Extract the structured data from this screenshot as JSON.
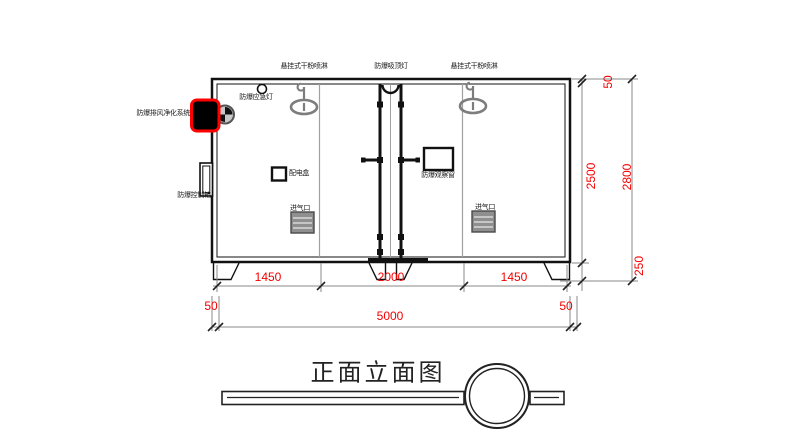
{
  "drawing": {
    "title": "正面立面图",
    "labels": {
      "sprinkler_left": "悬挂式干粉喷淋",
      "ceiling_light": "防爆吸顶灯",
      "sprinkler_right": "悬挂式干粉喷淋",
      "emergency_light": "防爆应急灯",
      "exhaust_purifier": "防爆排风净化系统",
      "control_box": "防爆控制箱",
      "power_box": "配电盒",
      "observation_window": "防爆观察窗",
      "air_inlet_left": "进气口",
      "air_inlet_right": "进气口"
    },
    "dimensions": {
      "seg_left": "1450",
      "seg_center": "2000",
      "seg_right": "1450",
      "offset_left": "50",
      "overall_width": "5000",
      "offset_right": "50",
      "right_top": "50",
      "inner_height": "2500",
      "overall_height": "2800",
      "base_height": "250"
    },
    "icons": {
      "sprinkler": "hanging-dry-powder-sprinkler-icon",
      "ceiling_light": "arc-ceiling-light-icon",
      "emergency_light": "round-emergency-light-icon",
      "exhaust_fan": "exhaust-fan-icon",
      "exhaust_unit": "highlighted-exhaust-purifier-unit"
    },
    "colors": {
      "dimension_text": "#f40000",
      "highlight": "#ff0000",
      "line": "#111111",
      "gray_part": "#7d7d7d"
    }
  }
}
